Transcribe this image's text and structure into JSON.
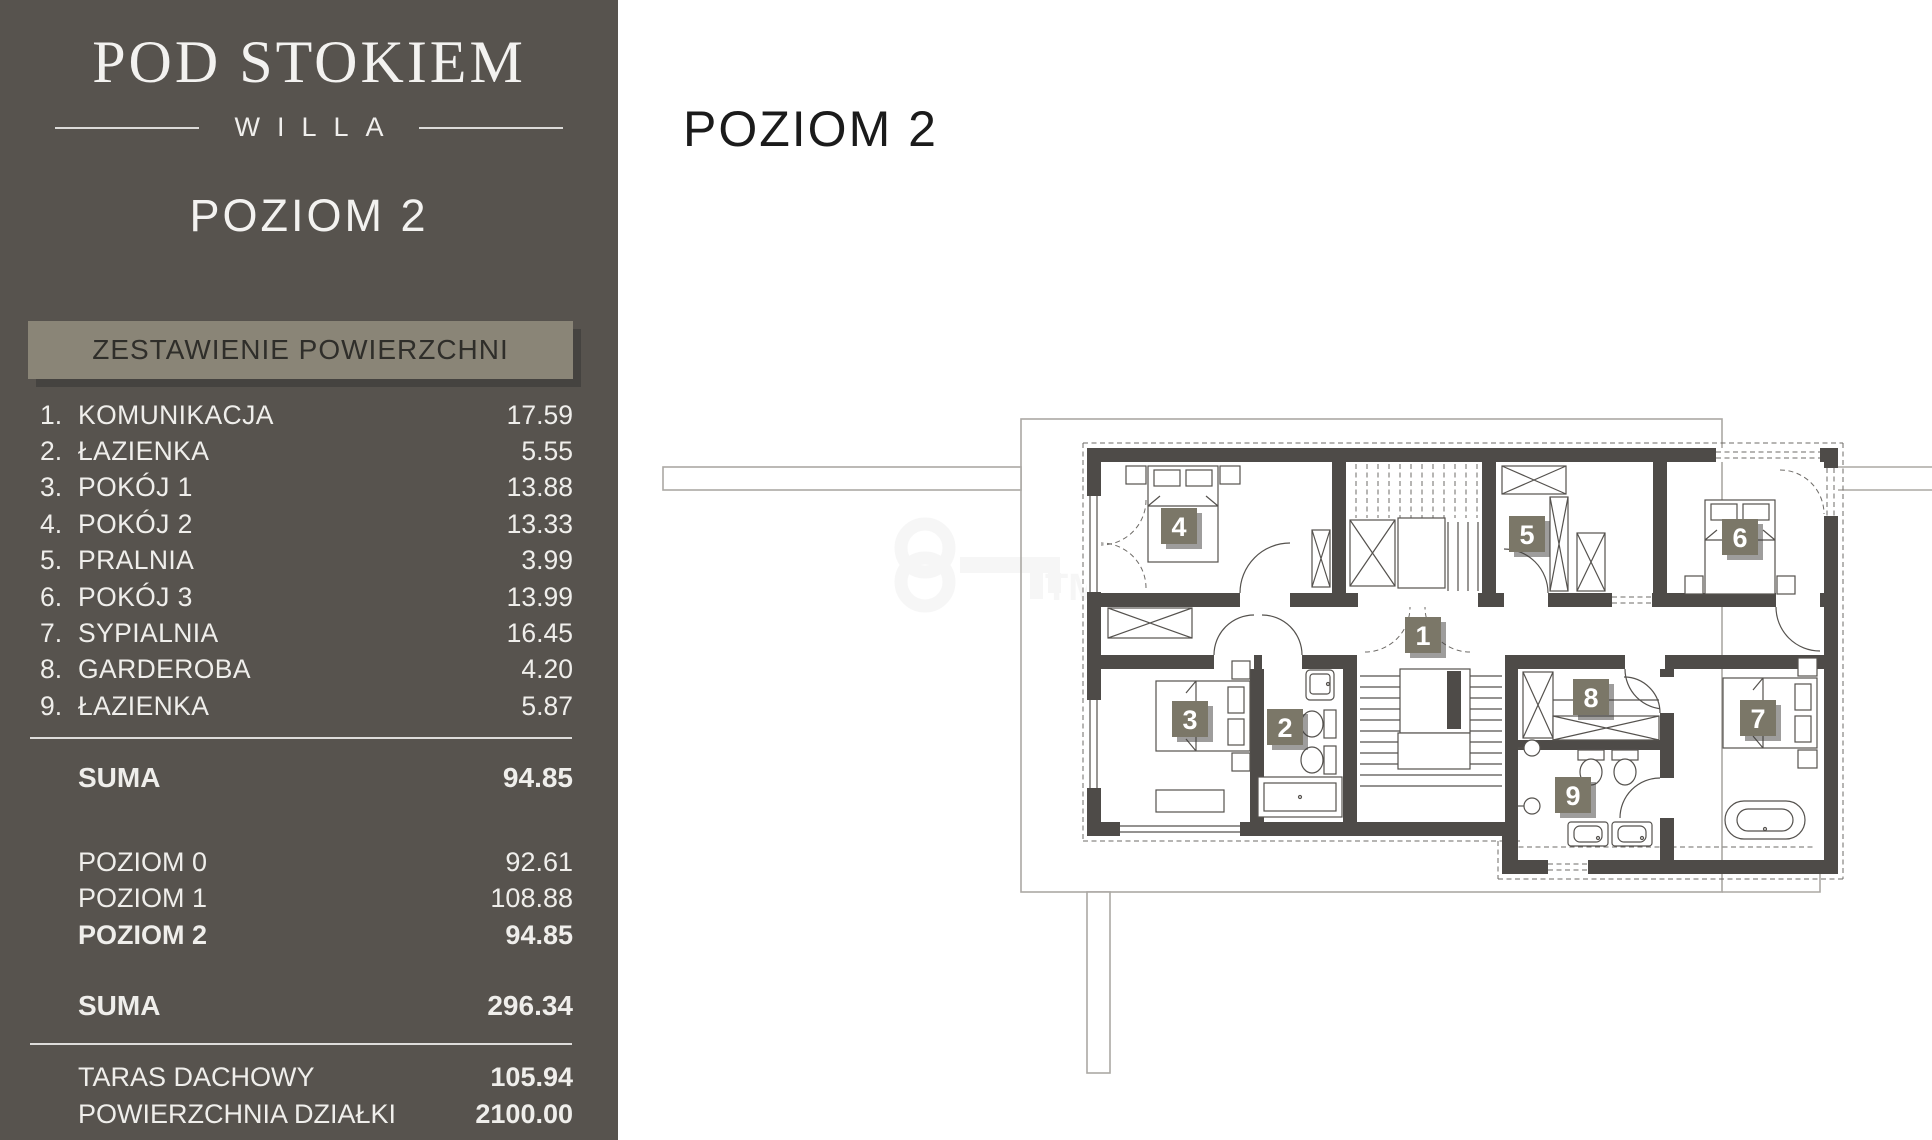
{
  "sidebar": {
    "logo_title": "POD STOKIEM",
    "logo_subtitle": "WILLA",
    "level_title": "POZIOM 2",
    "table_header": "ZESTAWIENIE POWIERZCHNI",
    "rooms": [
      {
        "no": "1.",
        "name": "KOMUNIKACJA",
        "area": "17.59"
      },
      {
        "no": "2.",
        "name": "ŁAZIENKA",
        "area": "5.55"
      },
      {
        "no": "3.",
        "name": "POKÓJ 1",
        "area": "13.88"
      },
      {
        "no": "4.",
        "name": "POKÓJ 2",
        "area": "13.33"
      },
      {
        "no": "5.",
        "name": "PRALNIA",
        "area": "3.99"
      },
      {
        "no": "6.",
        "name": "POKÓJ 3",
        "area": "13.99"
      },
      {
        "no": "7.",
        "name": "SYPIALNIA",
        "area": "16.45"
      },
      {
        "no": "8.",
        "name": "GARDEROBA",
        "area": "4.20"
      },
      {
        "no": "9.",
        "name": "ŁAZIENKA",
        "area": "5.87"
      }
    ],
    "level_sum": {
      "label": "SUMA",
      "value": "94.85"
    },
    "levels": [
      {
        "label": "POZIOM 0",
        "value": "92.61"
      },
      {
        "label": "POZIOM 1",
        "value": "108.88"
      },
      {
        "label": "POZIOM 2",
        "value": "94.85"
      }
    ],
    "total": {
      "label": "SUMA",
      "value": "296.34"
    },
    "extras": [
      {
        "label": "TARAS DACHOWY",
        "value": "105.94"
      },
      {
        "label": "POWIERZCHNIA DZIAŁKI",
        "value": "2100.00"
      }
    ]
  },
  "main": {
    "title": "POZIOM 2"
  },
  "plan": {
    "badges": [
      {
        "label": "1"
      },
      {
        "label": "2"
      },
      {
        "label": "3"
      },
      {
        "label": "4"
      },
      {
        "label": "5"
      },
      {
        "label": "6"
      },
      {
        "label": "7"
      },
      {
        "label": "8"
      },
      {
        "label": "9"
      }
    ],
    "watermark_label": "TM",
    "colors": {
      "sidebar_bg": "#57534E",
      "header_box_bg": "#8A8577",
      "badge_bg": "#7B7768",
      "wall": "#4E4B48"
    }
  }
}
